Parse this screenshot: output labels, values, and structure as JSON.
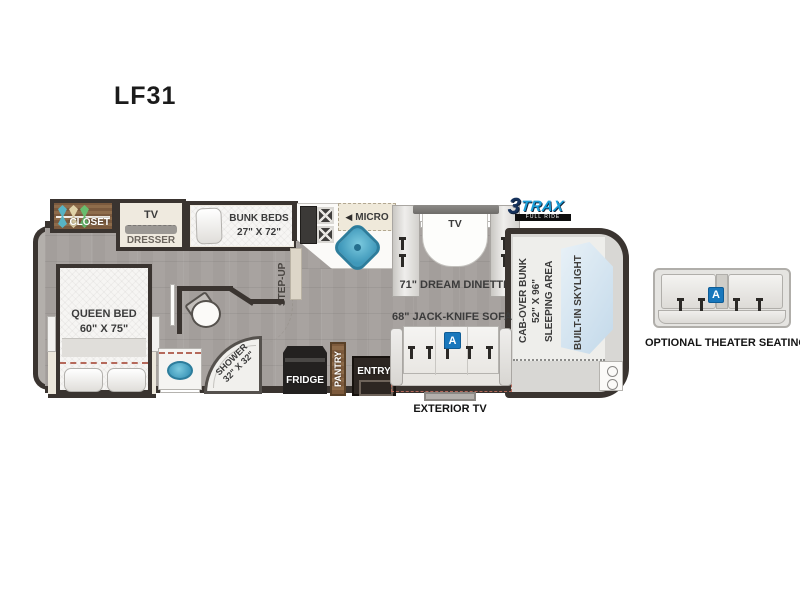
{
  "title": "LF31",
  "logo": {
    "brand_number": "3",
    "brand_name": "TRAX",
    "tagline": "FULL RIDE SYSTEM"
  },
  "plan": {
    "bedroom": {
      "closet": "CLOSET",
      "tv": "TV",
      "dresser": "DRESSER",
      "queen_bed_line1": "QUEEN BED",
      "queen_bed_line2": "60\" X 75\""
    },
    "bunk": {
      "line1": "BUNK BEDS",
      "line2": "27\" X 72\""
    },
    "kitchen": {
      "micro_arrow": "◀",
      "micro": "MICRO",
      "fridge": "FRIDGE",
      "pantry": "PANTRY"
    },
    "bath": {
      "shower_line1": "SHOWER",
      "shower_line2": "32\" X 32\""
    },
    "hall": {
      "step_up": "STEP-UP",
      "entry": "ENTRY"
    },
    "dinette": {
      "tv": "TV",
      "label": "71\" DREAM DINETTE"
    },
    "living": {
      "sofa": "68\" JACK-KNIFE SOFA",
      "badge": "A",
      "exterior_tv": "EXTERIOR TV"
    },
    "cab": {
      "line1": "CAB-OVER BUNK",
      "line2": "52\" X 96\"",
      "line3": "SLEEPING AREA",
      "skylight": "BUILT-IN SKYLIGHT"
    }
  },
  "options": {
    "theater": {
      "label": "OPTIONAL THEATER SEATING",
      "badge": "A"
    }
  },
  "colors": {
    "accent_blue": "#1877bc",
    "sink_blue": "#4aa5c4",
    "wall_dark": "#3a3430",
    "floor_gray": "#a8a3a0",
    "slide_cream": "#ece7db",
    "wood_brown": "#82613f",
    "logo_blue": "#1b9fd8",
    "logo_navy": "#16325c"
  }
}
